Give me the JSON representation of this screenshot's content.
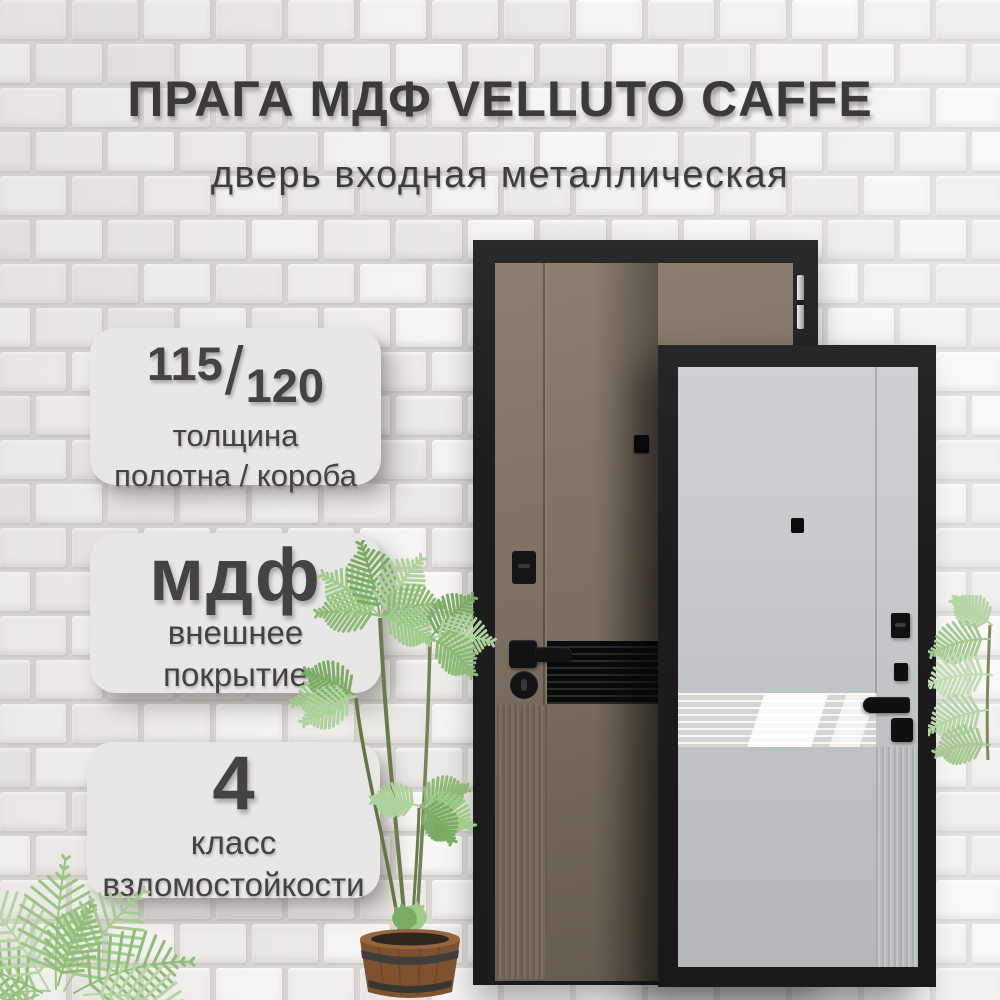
{
  "header": {
    "title": "ПРАГА МДФ VELLUTO CAFFE",
    "subtitle": "дверь входная металлическая"
  },
  "badges": {
    "thickness": {
      "leaf_mm": "115",
      "separator": "/",
      "frame_mm": "120",
      "caption_line1": "толщина",
      "caption_line2": "полотна / короба"
    },
    "coating": {
      "value": "мдф",
      "caption_line1": "внешнее",
      "caption_line2": "покрытие"
    },
    "burglary": {
      "value": "4",
      "caption_line1": "класс",
      "caption_line2": "взломостойкости"
    }
  },
  "colors": {
    "wall_mortar": "#d8d5d1",
    "badge_bg": "#e9e7e6",
    "text_dark": "#3b3a39",
    "frame_black": "#1e1e1e",
    "door_exterior_brown": "#7b7164",
    "door_interior_gray": "#c3c8ca",
    "mirror": "#e0e3dd",
    "leaf_green": "#9cc487",
    "pot_wood": "#7d5230"
  }
}
